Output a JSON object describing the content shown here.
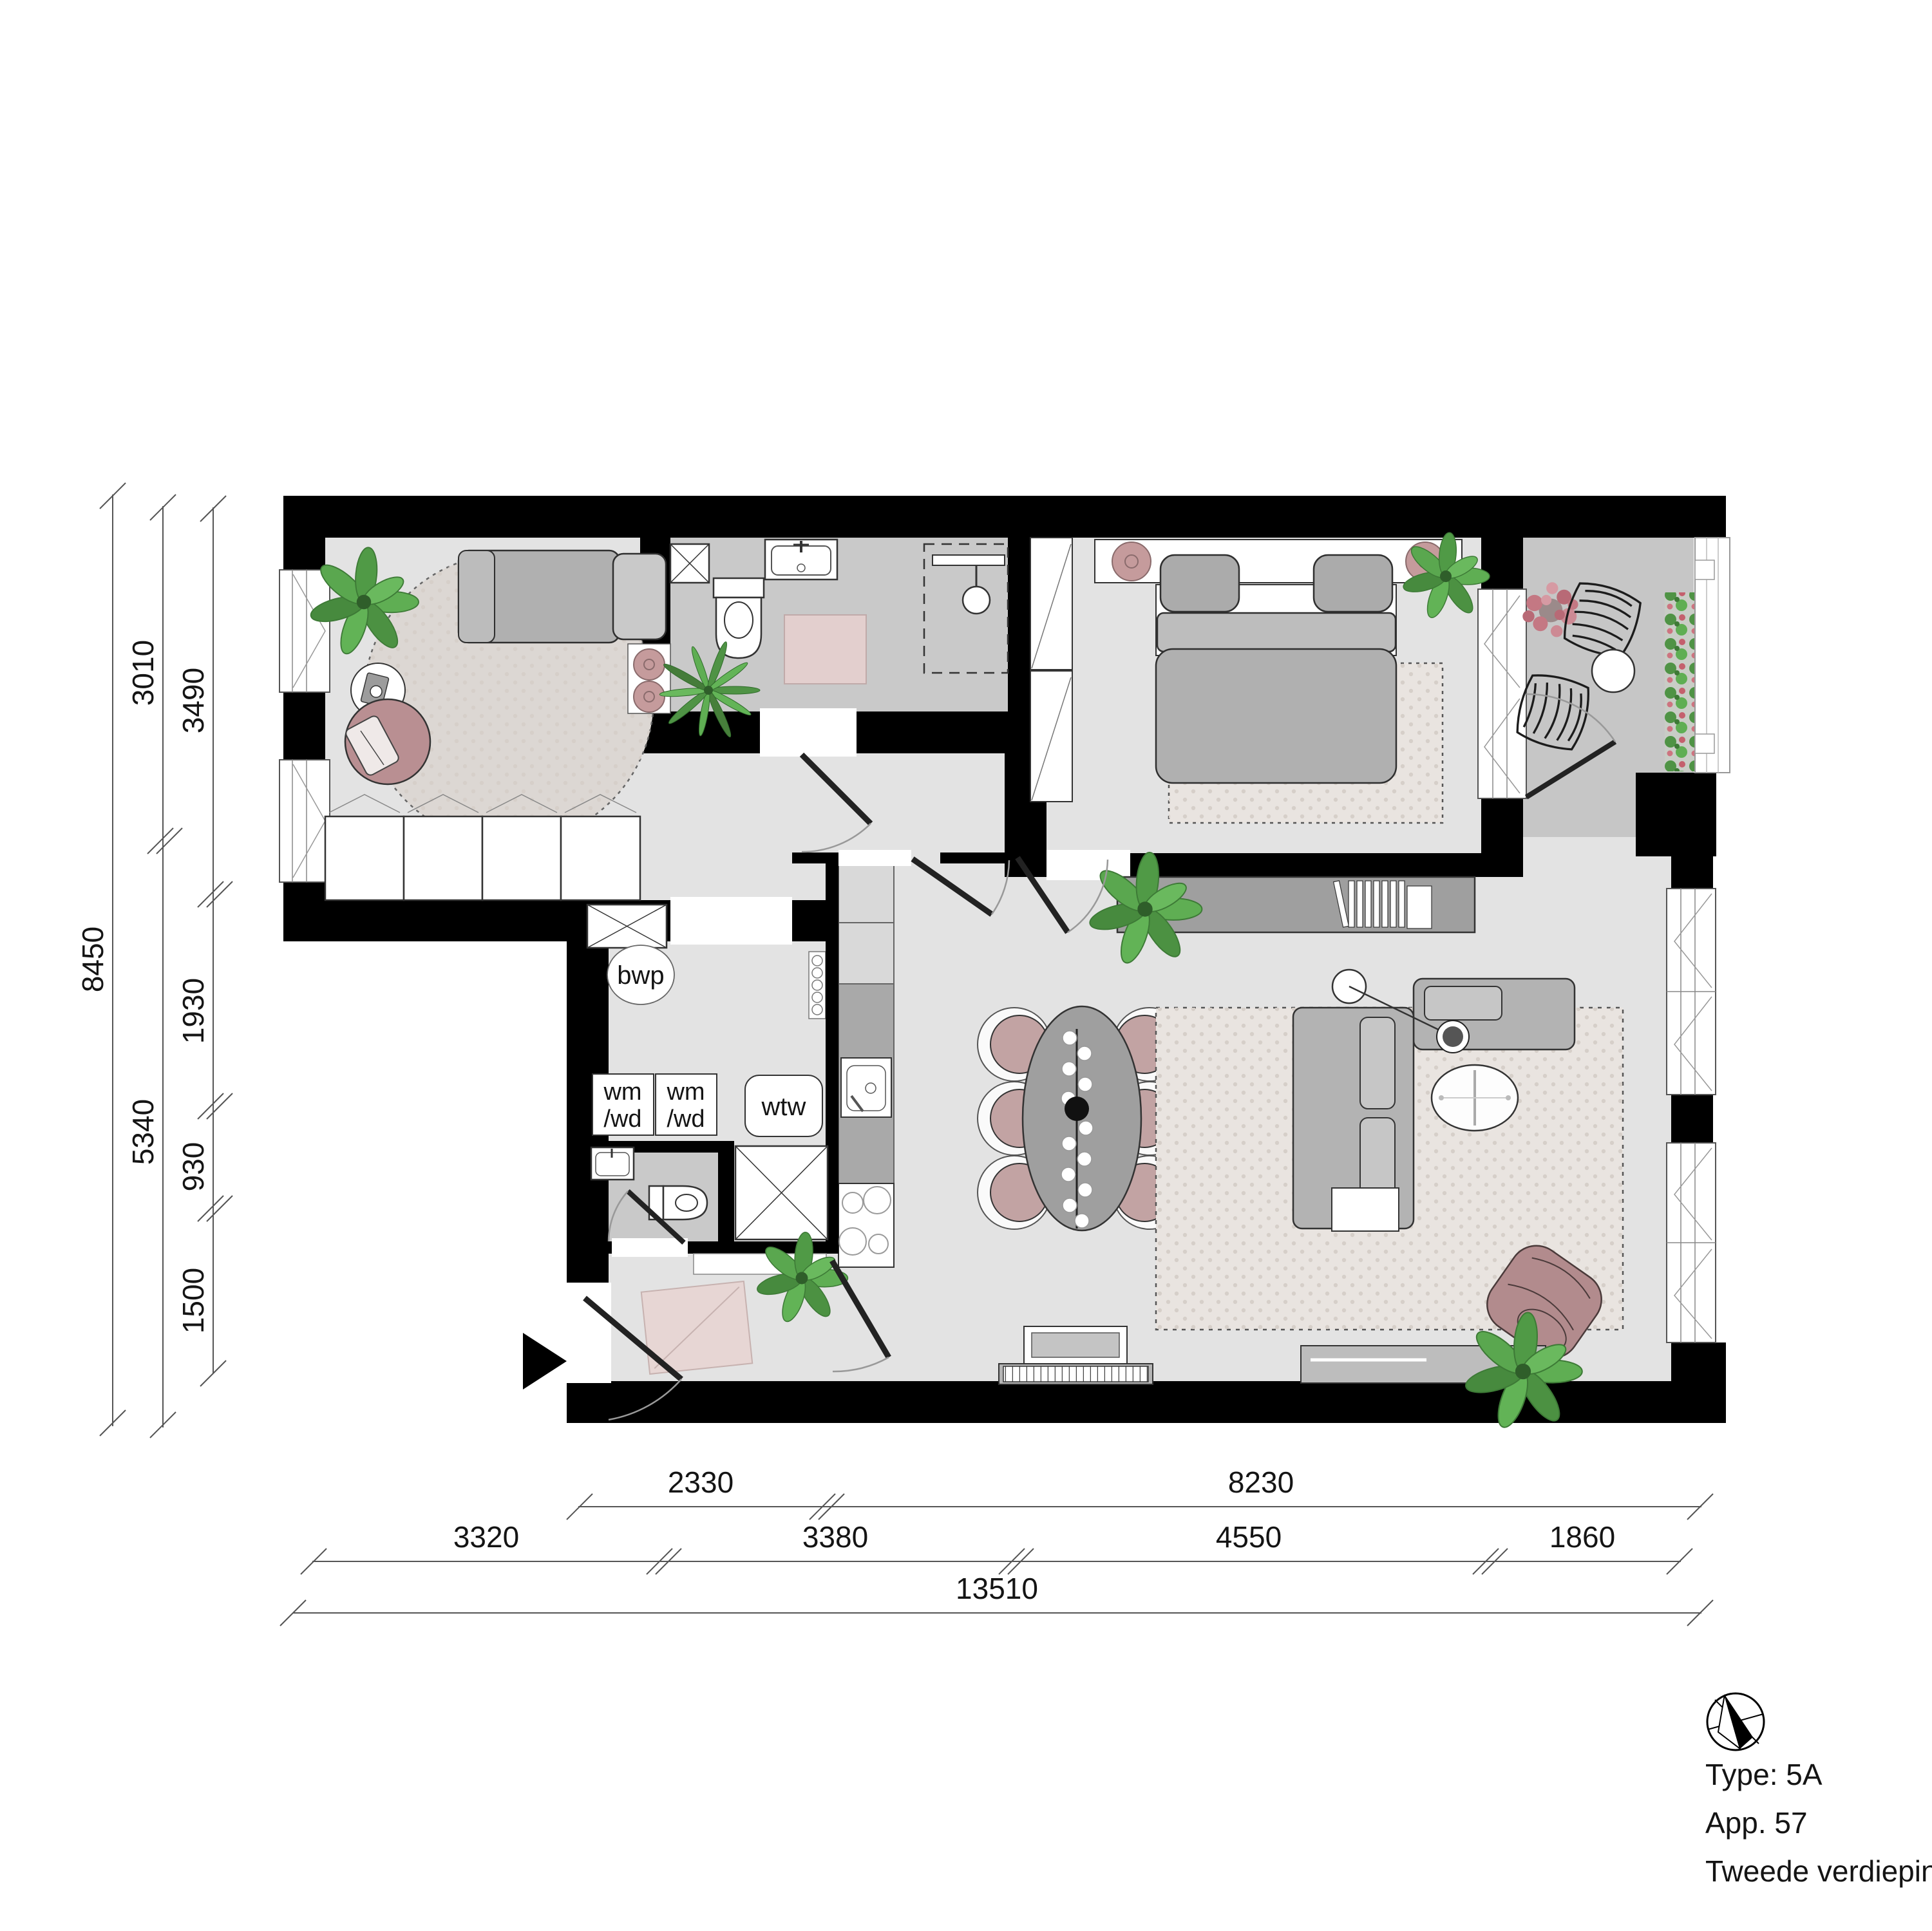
{
  "labels": {
    "bwp": "bwp",
    "wm1_line1": "wm",
    "wm1_line2": "/wd",
    "wm2_line1": "wm",
    "wm2_line2": "/wd",
    "wtw": "wtw"
  },
  "dimensions": {
    "left_total": "8450",
    "left_mid": [
      "3010",
      "5340"
    ],
    "left_inner": [
      "3490",
      "1930",
      "930",
      "1500"
    ],
    "bottom_top": [
      "2330",
      "8230"
    ],
    "bottom_mid": [
      "3320",
      "3380",
      "4550",
      "1860"
    ],
    "bottom_total": "13510"
  },
  "info": {
    "type": "Type: 5A",
    "apartment": "App. 57",
    "floor": "Tweede verdieping"
  },
  "colors": {
    "wall": "#000000",
    "floor": "#e3e3e3",
    "wet_floor": "#c9c9c9",
    "balcony_floor": "#c6c6c6",
    "rug": "#e9e4e0",
    "accent_pink": "#c59b9c",
    "furniture_gray": "#b3b3b3",
    "plant_green": "#55a04b"
  }
}
